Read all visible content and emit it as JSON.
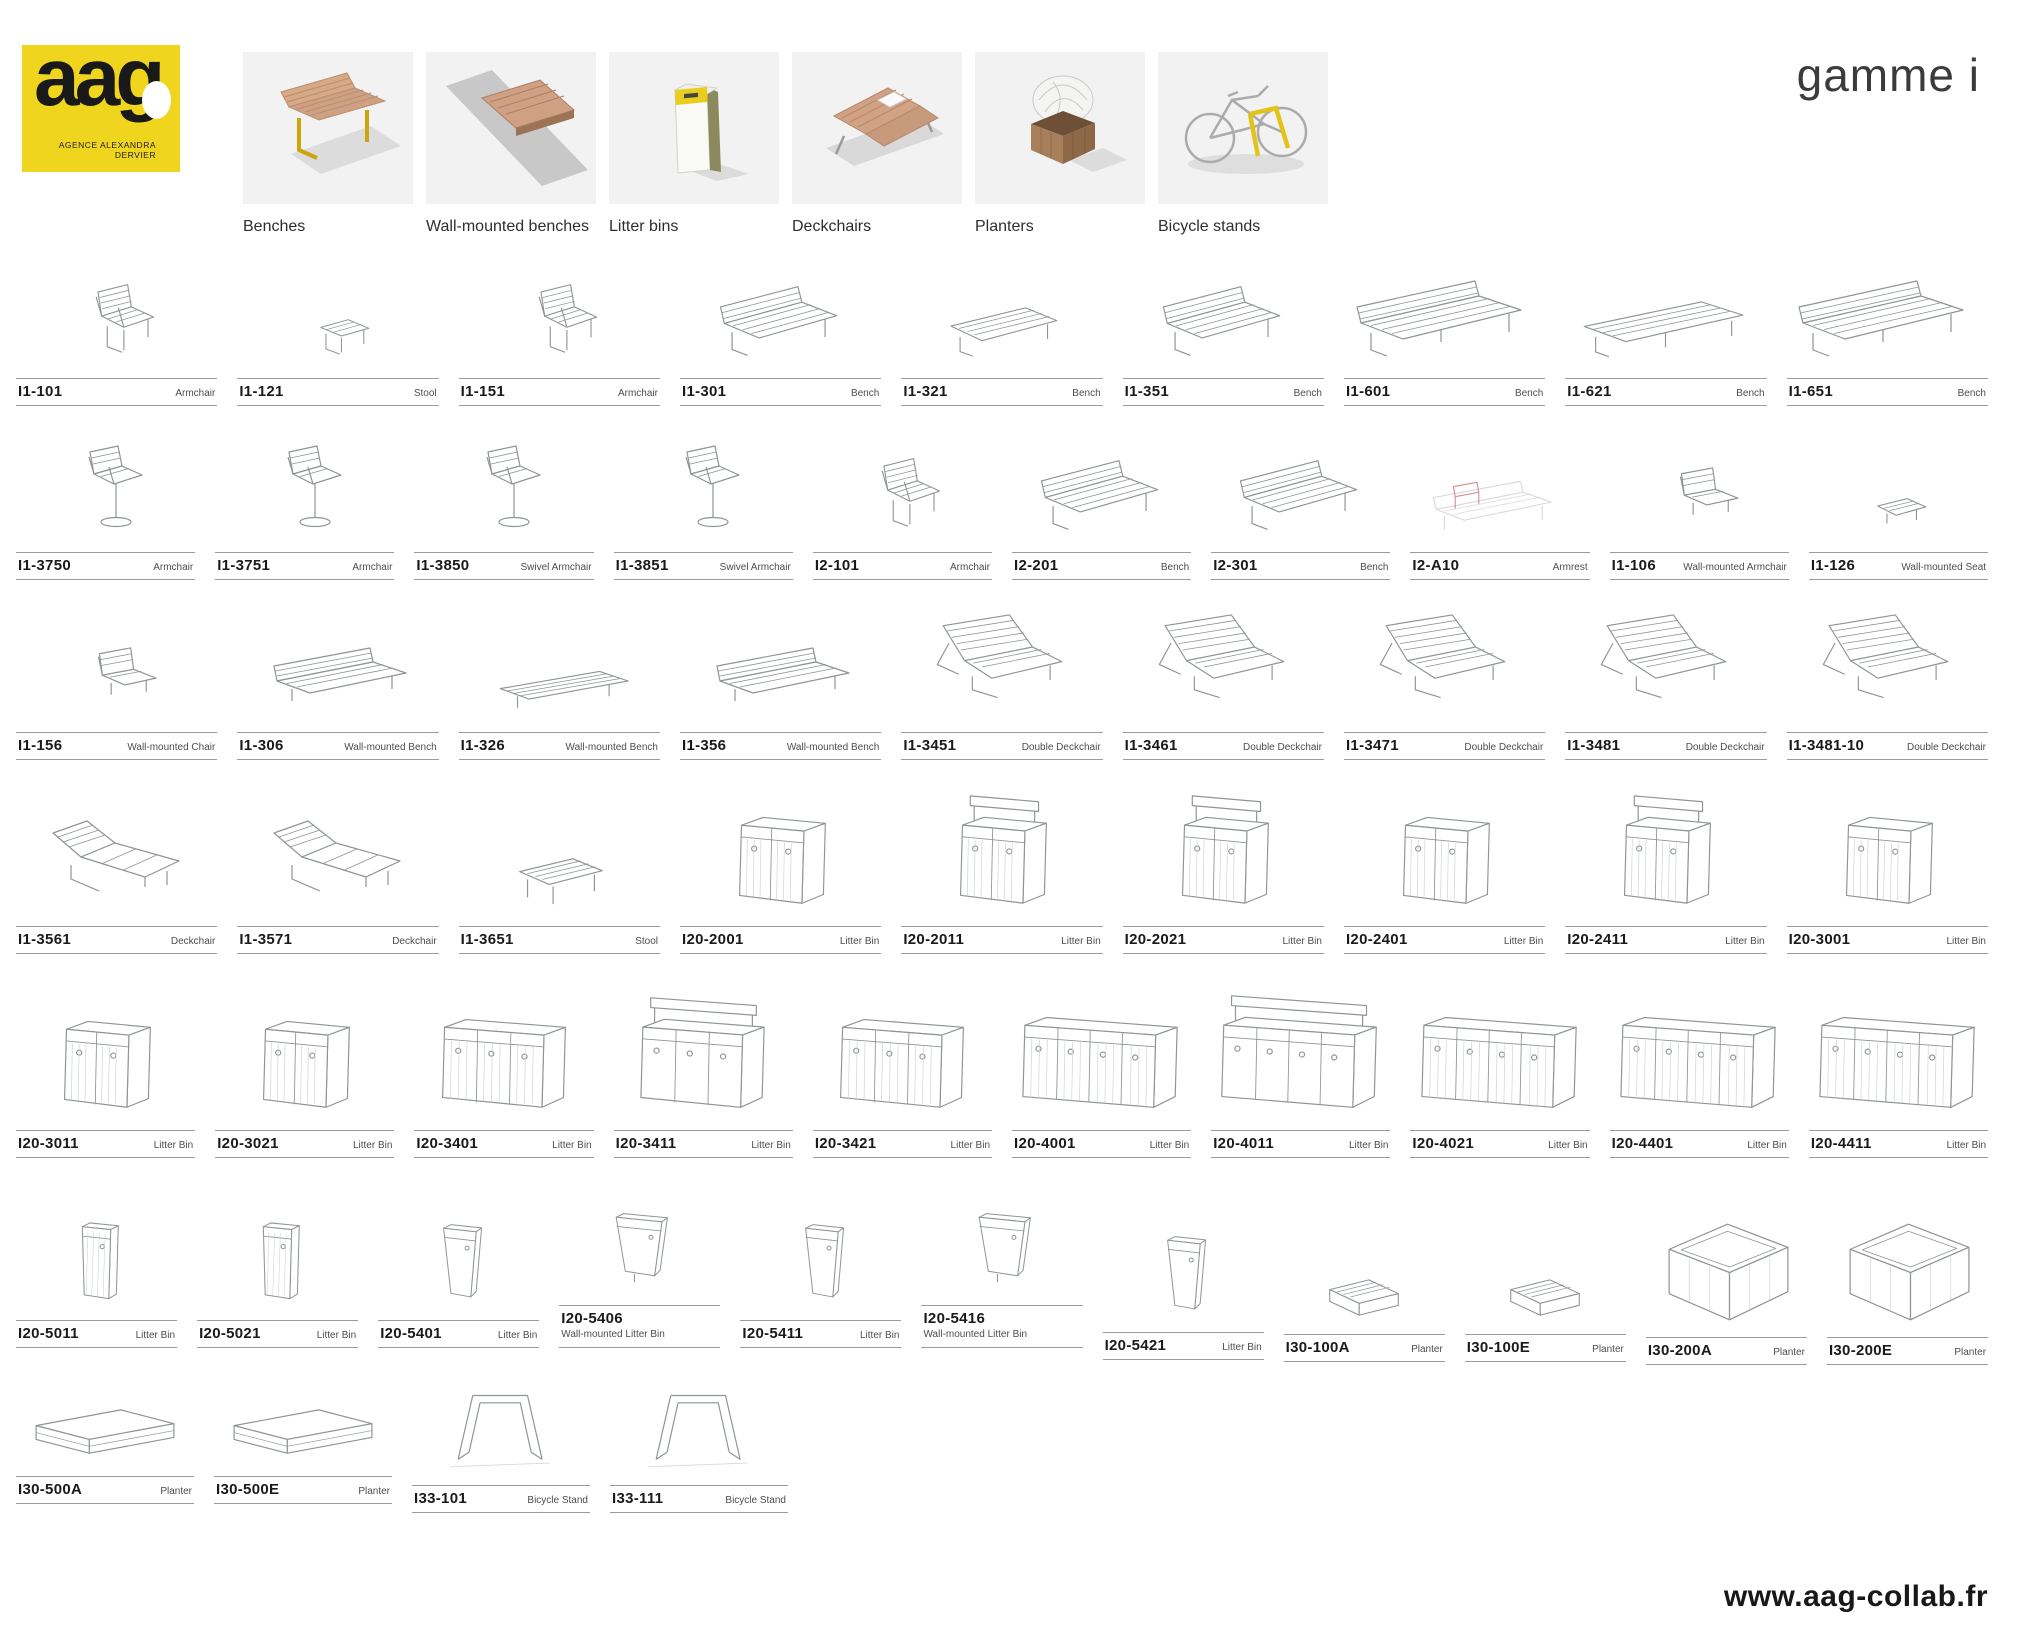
{
  "meta": {
    "brand_yellow": "#EFD51E",
    "wood_color": "#CFA083",
    "tile_background": "#F2F2F2",
    "sketch_stroke": "#8E9498",
    "accent_red": "#D98F8F"
  },
  "header": {
    "logo": {
      "text": "aag",
      "tagline_line1": "AGENCE ALEXANDRA",
      "tagline_line2": "DERVIER"
    },
    "range_title": "gamme i",
    "categories": [
      {
        "label": "Benches",
        "icon": "bench-thumbnail-icon"
      },
      {
        "label": "Wall-mounted benches",
        "icon": "wall-bench-thumbnail-icon"
      },
      {
        "label": "Litter bins",
        "icon": "litter-bin-thumbnail-icon"
      },
      {
        "label": "Deckchairs",
        "icon": "deckchair-thumbnail-icon"
      },
      {
        "label": "Planters",
        "icon": "planter-thumbnail-icon"
      },
      {
        "label": "Bicycle stands",
        "icon": "bicycle-stand-thumbnail-icon"
      }
    ]
  },
  "products": {
    "rows": [
      [
        {
          "code": "I1-101",
          "type": "Armchair",
          "sketch": "chair"
        },
        {
          "code": "I1-121",
          "type": "Stool",
          "sketch": "stool"
        },
        {
          "code": "I1-151",
          "type": "Armchair",
          "sketch": "chair"
        },
        {
          "code": "I1-301",
          "type": "Bench",
          "sketch": "bench"
        },
        {
          "code": "I1-321",
          "type": "Bench",
          "sketch": "bench-flat"
        },
        {
          "code": "I1-351",
          "type": "Bench",
          "sketch": "bench"
        },
        {
          "code": "I1-601",
          "type": "Bench",
          "sketch": "bench-long"
        },
        {
          "code": "I1-621",
          "type": "Bench",
          "sketch": "bench-flat-long"
        },
        {
          "code": "I1-651",
          "type": "Bench",
          "sketch": "bench-long"
        }
      ],
      [
        {
          "code": "I1-3750",
          "type": "Armchair",
          "sketch": "swivel"
        },
        {
          "code": "I1-3751",
          "type": "Armchair",
          "sketch": "swivel"
        },
        {
          "code": "I1-3850",
          "type": "Swivel Armchair",
          "sketch": "swivel"
        },
        {
          "code": "I1-3851",
          "type": "Swivel Armchair",
          "sketch": "swivel"
        },
        {
          "code": "I2-101",
          "type": "Armchair",
          "sketch": "chair"
        },
        {
          "code": "I2-201",
          "type": "Bench",
          "sketch": "bench"
        },
        {
          "code": "I2-301",
          "type": "Bench",
          "sketch": "bench"
        },
        {
          "code": "I2-A10",
          "type": "Armrest",
          "sketch": "armrest-bench"
        },
        {
          "code": "I1-106",
          "type": "Wall-mounted Armchair",
          "sketch": "wall-chair"
        },
        {
          "code": "I1-126",
          "type": "Wall-mounted Seat",
          "sketch": "wall-seat"
        }
      ],
      [
        {
          "code": "I1-156",
          "type": "Wall-mounted Chair",
          "sketch": "wall-chair"
        },
        {
          "code": "I1-306",
          "type": "Wall-mounted Bench",
          "sketch": "wall-bench"
        },
        {
          "code": "I1-326",
          "type": "Wall-mounted Bench",
          "sketch": "wall-bench-flat"
        },
        {
          "code": "I1-356",
          "type": "Wall-mounted Bench",
          "sketch": "wall-bench"
        },
        {
          "code": "I1-3451",
          "type": "Double Deckchair",
          "sketch": "deck-double"
        },
        {
          "code": "I1-3461",
          "type": "Double Deckchair",
          "sketch": "deck-double"
        },
        {
          "code": "I1-3471",
          "type": "Double Deckchair",
          "sketch": "deck-double"
        },
        {
          "code": "I1-3481",
          "type": "Double Deckchair",
          "sketch": "deck-double"
        },
        {
          "code": "I1-3481-10",
          "type": "Double Deckchair",
          "sketch": "deck-double"
        }
      ],
      [
        {
          "code": "I1-3561",
          "type": "Deckchair",
          "sketch": "deckchair"
        },
        {
          "code": "I1-3571",
          "type": "Deckchair",
          "sketch": "deckchair"
        },
        {
          "code": "I1-3651",
          "type": "Stool",
          "sketch": "low-table"
        },
        {
          "code": "I20-2001",
          "type": "Litter Bin",
          "sketch": "bin2"
        },
        {
          "code": "I20-2011",
          "type": "Litter Bin",
          "sketch": "bin2h"
        },
        {
          "code": "I20-2021",
          "type": "Litter Bin",
          "sketch": "bin2h"
        },
        {
          "code": "I20-2401",
          "type": "Litter Bin",
          "sketch": "bin2"
        },
        {
          "code": "I20-2411",
          "type": "Litter Bin",
          "sketch": "bin2h"
        },
        {
          "code": "I20-3001",
          "type": "Litter Bin",
          "sketch": "bin2"
        }
      ],
      [
        {
          "code": "I20-3011",
          "type": "Litter Bin",
          "sketch": "bin2"
        },
        {
          "code": "I20-3021",
          "type": "Litter Bin",
          "sketch": "bin2"
        },
        {
          "code": "I20-3401",
          "type": "Litter Bin",
          "sketch": "bin3"
        },
        {
          "code": "I20-3411",
          "type": "Litter Bin",
          "sketch": "bin3h"
        },
        {
          "code": "I20-3421",
          "type": "Litter Bin",
          "sketch": "bin3"
        },
        {
          "code": "I20-4001",
          "type": "Litter Bin",
          "sketch": "bin4"
        },
        {
          "code": "I20-4011",
          "type": "Litter Bin",
          "sketch": "bin4h"
        },
        {
          "code": "I20-4021",
          "type": "Litter Bin",
          "sketch": "bin4"
        },
        {
          "code": "I20-4401",
          "type": "Litter Bin",
          "sketch": "bin4"
        },
        {
          "code": "I20-4411",
          "type": "Litter Bin",
          "sketch": "bin4"
        }
      ],
      [
        {
          "code": "I20-5011",
          "type": "Litter Bin",
          "sketch": "bin1"
        },
        {
          "code": "I20-5021",
          "type": "Litter Bin",
          "sketch": "bin1"
        },
        {
          "code": "I20-5401",
          "type": "Litter Bin",
          "sketch": "binwedge"
        },
        {
          "code": "I20-5406",
          "type": "Wall-mounted Litter Bin",
          "sketch": "binwall",
          "stacked": true
        },
        {
          "code": "I20-5411",
          "type": "Litter Bin",
          "sketch": "binwedge"
        },
        {
          "code": "I20-5416",
          "type": "Wall-mounted Litter Bin",
          "sketch": "binwall",
          "stacked": true
        },
        {
          "code": "I20-5421",
          "type": "Litter Bin",
          "sketch": "binwedge"
        },
        {
          "code": "I30-100A",
          "type": "Planter",
          "sketch": "planter-s"
        },
        {
          "code": "I30-100E",
          "type": "Planter",
          "sketch": "planter-s"
        },
        {
          "code": "I30-200A",
          "type": "Planter",
          "sketch": "planter-cube"
        },
        {
          "code": "I30-200E",
          "type": "Planter",
          "sketch": "planter-cube"
        }
      ],
      [
        {
          "code": "I30-500A",
          "type": "Planter",
          "sketch": "planter-long"
        },
        {
          "code": "I30-500E",
          "type": "Planter",
          "sketch": "planter-long"
        },
        {
          "code": "I33-101",
          "type": "Bicycle Stand",
          "sketch": "bike"
        },
        {
          "code": "I33-111",
          "type": "Bicycle Stand",
          "sketch": "bike"
        }
      ]
    ]
  },
  "footer": {
    "website": "www.aag-collab.fr"
  }
}
